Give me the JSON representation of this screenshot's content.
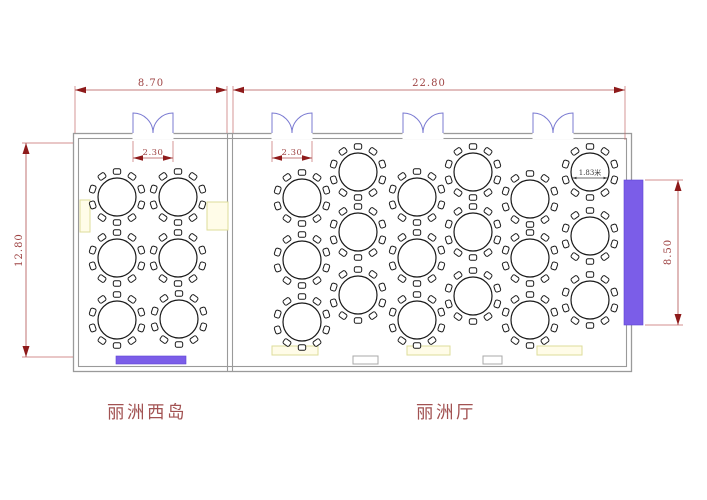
{
  "canvas": {
    "width": 707,
    "height": 500,
    "background": "#ffffff"
  },
  "rooms": {
    "left": {
      "name": "丽洲西岛"
    },
    "right": {
      "name": "丽洲厅"
    }
  },
  "dims": {
    "left_room_width": "8.70",
    "right_room_width": "22.80",
    "hall_depth": "12.80",
    "stage_length": "8.50",
    "table_diameter_label": "1.83米"
  },
  "doors": [
    {
      "x": 133,
      "w": 40,
      "dim": "2.30"
    },
    {
      "x": 272,
      "w": 40,
      "dim": "2.30"
    },
    {
      "x": 403,
      "w": 40
    },
    {
      "x": 533,
      "w": 40
    }
  ],
  "tables": {
    "radius": 19,
    "chair_ring_radius": 25.5,
    "chairs_per_table": 10,
    "left_room": [
      [
        117,
        197
      ],
      [
        178,
        197
      ],
      [
        117,
        258
      ],
      [
        178,
        258
      ],
      [
        117,
        320
      ],
      [
        179,
        319
      ]
    ],
    "right_room": [
      [
        302,
        198
      ],
      [
        302,
        260
      ],
      [
        302,
        322
      ],
      [
        358,
        172
      ],
      [
        358,
        232
      ],
      [
        358,
        295
      ],
      [
        417,
        197
      ],
      [
        417,
        258
      ],
      [
        417,
        320
      ],
      [
        473,
        172
      ],
      [
        473,
        232
      ],
      [
        473,
        296
      ],
      [
        530,
        199
      ],
      [
        530,
        258
      ],
      [
        530,
        320
      ],
      [
        590,
        172
      ],
      [
        590,
        236
      ],
      [
        590,
        300
      ]
    ],
    "labeled_table_index": 15
  },
  "colors": {
    "wall": "#9a9a9a",
    "door": "#7b7bd2",
    "dimension_line": "#b05050",
    "dimension_arrow": "#8e1a1a",
    "dimension_text": "#9e4343",
    "room_label_text": "#a25252",
    "stage_fill": "#7b5de8",
    "service_table_fill": "#fffce8",
    "service_table_border": "#dedc9a",
    "table_outline": "#1a1a1a"
  }
}
